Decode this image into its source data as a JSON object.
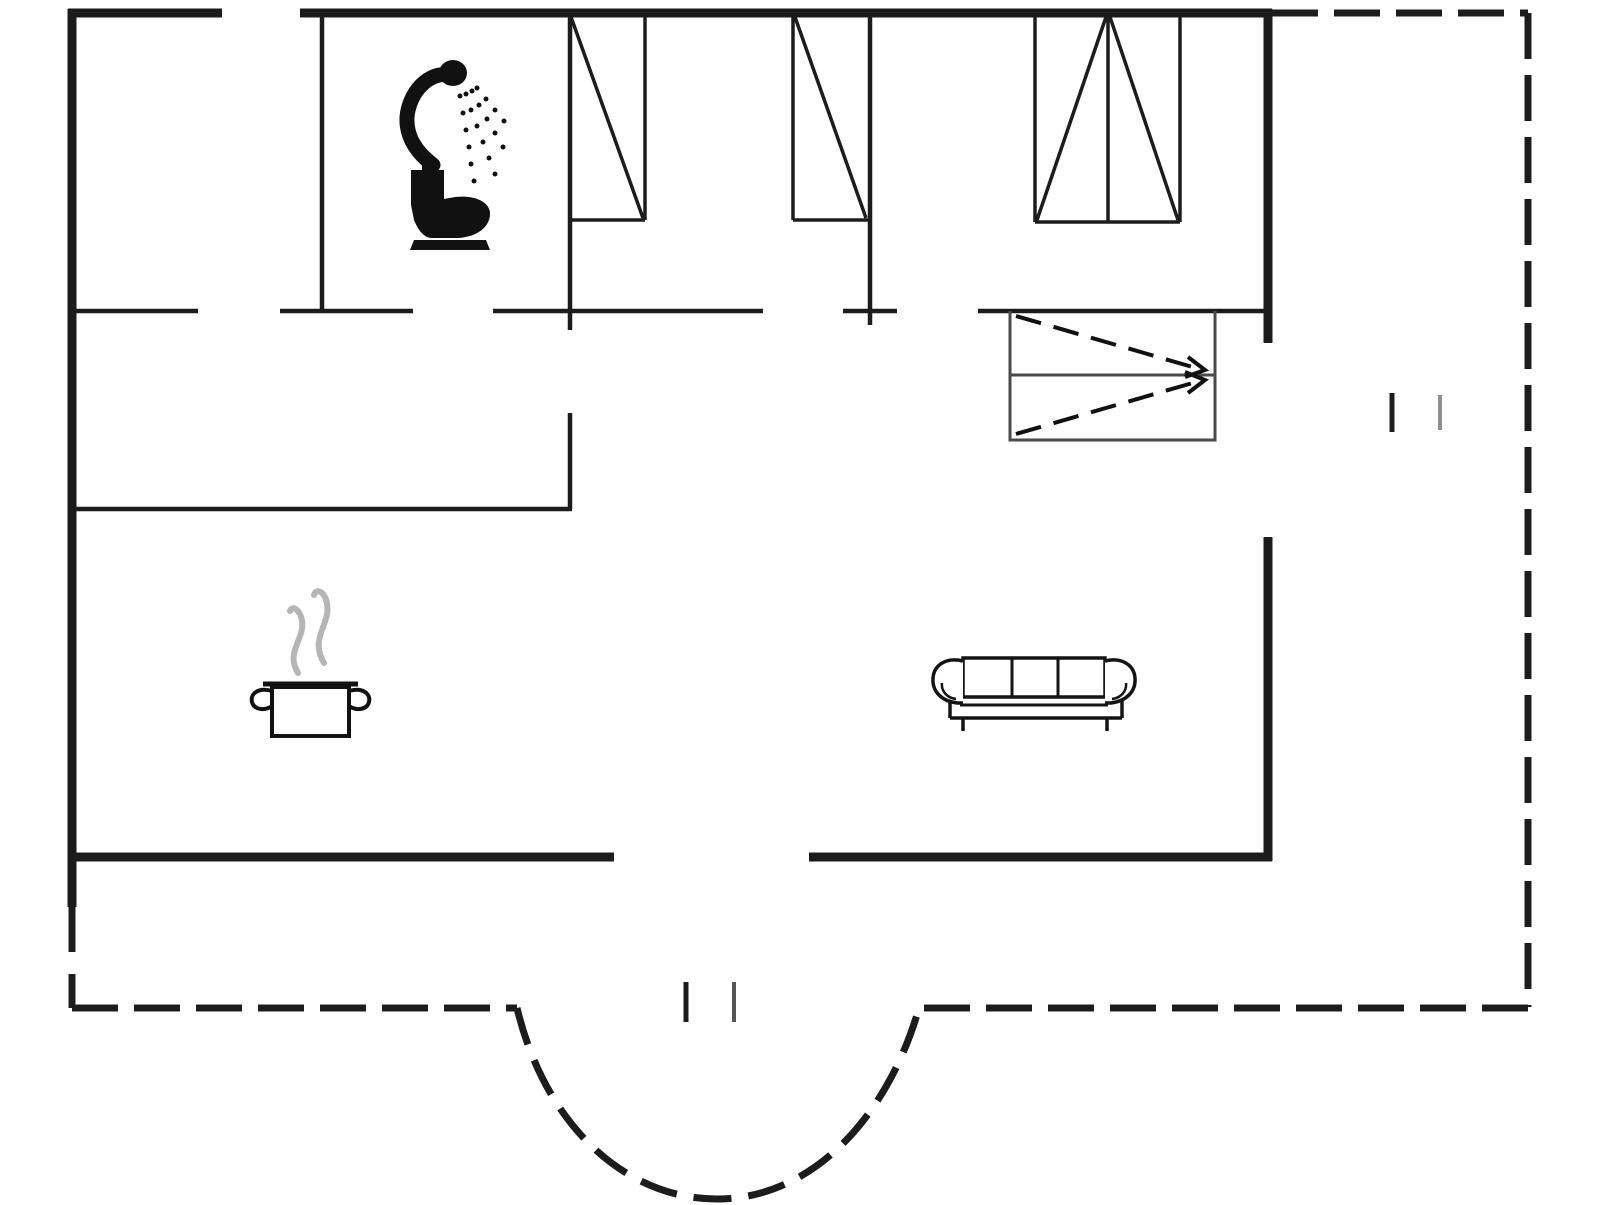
{
  "page": {
    "background": "#ffffff",
    "description": "house floor plan drawing"
  },
  "floorplan": {
    "viewbox": "0 0 1606 1205",
    "colors": {
      "wall": "#1c1c1c",
      "icon": "#111111",
      "closet_outline": "#4a4a4a",
      "steam": "#b5b5b5",
      "tick_dark": "#1c1c1c",
      "tick_light": "#8f8f8f",
      "tick_mid": "#555555",
      "background": "#ffffff"
    },
    "elements": [
      {
        "name": "top-wall-left",
        "kind": "path",
        "d": "M68,13 H222",
        "stroke": "#1c1c1c",
        "width": 9
      },
      {
        "name": "top-wall-main",
        "kind": "path",
        "d": "M300,13 H1272",
        "stroke": "#1c1c1c",
        "width": 9
      },
      {
        "name": "left-wall",
        "kind": "path",
        "d": "M72,9 V907",
        "stroke": "#1c1c1c",
        "width": 9
      },
      {
        "name": "right-wall-upper",
        "kind": "path",
        "d": "M1268,9 V343",
        "stroke": "#1c1c1c",
        "width": 9
      },
      {
        "name": "right-wall-lower",
        "kind": "path",
        "d": "M1268,537 V861",
        "stroke": "#1c1c1c",
        "width": 9
      },
      {
        "name": "bottom-wall-left",
        "kind": "path",
        "d": "M68,857 H614",
        "stroke": "#1c1c1c",
        "width": 9
      },
      {
        "name": "bottom-wall-right",
        "kind": "path",
        "d": "M809,857 H1272",
        "stroke": "#1c1c1c",
        "width": 9
      },
      {
        "name": "terrace-boundary-top",
        "kind": "path",
        "d": "M1272,13 H1528",
        "stroke": "#1c1c1c",
        "width": 7,
        "dash": "46 16"
      },
      {
        "name": "terrace-boundary-right",
        "kind": "path",
        "d": "M1528,13 V1007",
        "stroke": "#1c1c1c",
        "width": 7,
        "dash": "46 16"
      },
      {
        "name": "terrace-boundary-bottom-right",
        "kind": "path",
        "d": "M1528,1008 H919",
        "stroke": "#1c1c1c",
        "width": 7,
        "dash": "46 16"
      },
      {
        "name": "terrace-boundary-bottom-left",
        "kind": "path",
        "d": "M72,1008 H517",
        "stroke": "#1c1c1c",
        "width": 7,
        "dash": "46 16"
      },
      {
        "name": "left-wall-dashed",
        "kind": "path",
        "d": "M72,902 V1008",
        "stroke": "#1c1c1c",
        "width": 7,
        "dash": "50 22"
      },
      {
        "name": "bay-curve",
        "kind": "path",
        "d": "M517,1008 C545,1125 625,1199 717,1199 C809,1199 886,1122 919,1008",
        "stroke": "#1c1c1c",
        "width": 7,
        "dash": "38 17"
      },
      {
        "name": "hall-wall-a",
        "kind": "path",
        "d": "M72,311 H198",
        "stroke": "#1c1c1c",
        "width": 4.5
      },
      {
        "name": "hall-wall-b",
        "kind": "path",
        "d": "M280,311 H413",
        "stroke": "#1c1c1c",
        "width": 4.5
      },
      {
        "name": "hall-wall-c",
        "kind": "path",
        "d": "M493,311 H763",
        "stroke": "#1c1c1c",
        "width": 4.5
      },
      {
        "name": "hall-wall-d",
        "kind": "path",
        "d": "M843,311 H897",
        "stroke": "#1c1c1c",
        "width": 4.5
      },
      {
        "name": "hall-wall-e",
        "kind": "path",
        "d": "M978,311 H1267",
        "stroke": "#1c1c1c",
        "width": 4.5
      },
      {
        "name": "bathroom-wall-left",
        "kind": "path",
        "d": "M322,13 V311",
        "stroke": "#1c1c1c",
        "width": 4.5
      },
      {
        "name": "bathroom-wall-right",
        "kind": "path",
        "d": "M570,13 V330",
        "stroke": "#1c1c1c",
        "width": 4.5
      },
      {
        "name": "kitchen-wall-vertical",
        "kind": "path",
        "d": "M570,413 V509",
        "stroke": "#1c1c1c",
        "width": 4.5
      },
      {
        "name": "kitchen-wall-horizontal",
        "kind": "path",
        "d": "M72,509 H572",
        "stroke": "#1c1c1c",
        "width": 4.5
      },
      {
        "name": "bedroom-divider-wall",
        "kind": "path",
        "d": "M870,13 V325",
        "stroke": "#1c1c1c",
        "width": 4.5
      },
      {
        "name": "wardrobe-1",
        "kind": "path",
        "d": "M645,15 V220 M569,220 H645 M571,17 L643,218",
        "stroke": "#1c1c1c",
        "width": 3.5
      },
      {
        "name": "wardrobe-2",
        "kind": "path",
        "d": "M793,15 V220 M793,220 H868 M795,17 L866,218",
        "stroke": "#1c1c1c",
        "width": 3.5
      },
      {
        "name": "wardrobe-3",
        "kind": "path",
        "d": "M1035,15 V222 M1180,15 V222 M1035,222 H1180 M1108,15 V222 M1037,220 L1106,17 M1110,17 L1178,220",
        "stroke": "#1c1c1c",
        "width": 3.5
      },
      {
        "name": "closet-outline",
        "kind": "path",
        "d": "M1010,311 V440 H1215 V311 M1010,375 H1215",
        "stroke": "#4a4a4a",
        "width": 3
      },
      {
        "name": "closet-arrow-1",
        "kind": "path",
        "d": "M1016,316 L1196,368",
        "stroke": "#111111",
        "width": 4,
        "dash": "26 13"
      },
      {
        "name": "closet-arrow-1-head",
        "kind": "path",
        "d": "M1188,357 L1205,370 L1185,377",
        "stroke": "#111111",
        "width": 4
      },
      {
        "name": "closet-arrow-2",
        "kind": "path",
        "d": "M1016,434 L1196,382",
        "stroke": "#111111",
        "width": 4,
        "dash": "26 13"
      },
      {
        "name": "closet-arrow-2-head",
        "kind": "path",
        "d": "M1188,393 L1205,380 L1185,372",
        "stroke": "#111111",
        "width": 4
      },
      {
        "name": "window-marker-east-tick-1",
        "kind": "path",
        "d": "M1392,393 V432",
        "stroke": "#1c1c1c",
        "width": 5
      },
      {
        "name": "window-marker-east-tick-2",
        "kind": "path",
        "d": "M1440,395 V430",
        "stroke": "#8f8f8f",
        "width": 4
      },
      {
        "name": "door-marker-south-tick-1",
        "kind": "path",
        "d": "M686,982 V1022",
        "stroke": "#1c1c1c",
        "width": 5
      },
      {
        "name": "door-marker-south-tick-2",
        "kind": "path",
        "d": "M734,982 V1022",
        "stroke": "#555555",
        "width": 4
      },
      {
        "name": "shower-icon-head",
        "kind": "path",
        "d": "M439,73 a14,13 0 1,0 28,0 a14,13 0 1,0 -28,0",
        "stroke": "none",
        "width": 0,
        "fill": "#111111"
      },
      {
        "name": "shower-icon-hose",
        "kind": "path",
        "d": "M453,75 C427,70 409,94 407,117 C406,137 416,152 433,165",
        "stroke": "#111111",
        "width": 15,
        "cap": "round"
      },
      {
        "name": "shower-icon-spray-dots",
        "kind": "dots",
        "r": 2.5,
        "fill": "#111111",
        "points": [
          [
            460,
            96
          ],
          [
            463,
            113
          ],
          [
            466,
            130
          ],
          [
            469,
            147
          ],
          [
            471,
            164
          ],
          [
            474,
            181
          ],
          [
            466,
            94
          ],
          [
            471,
            110
          ],
          [
            477,
            126
          ],
          [
            483,
            142
          ],
          [
            489,
            158
          ],
          [
            495,
            174
          ],
          [
            472,
            91
          ],
          [
            479,
            105
          ],
          [
            487,
            119
          ],
          [
            495,
            133
          ],
          [
            503,
            147
          ],
          [
            477,
            88
          ],
          [
            486,
            99
          ],
          [
            495,
            110
          ],
          [
            504,
            121
          ]
        ]
      },
      {
        "name": "toilet-icon",
        "kind": "path",
        "d": "M422,159 H434 V170 H422 Z M411,170 H444 V199 L455,197 C472,195 488,200 490,212 C491,226 478,237 458,238 L432,238 C424,238 418,230 414,220 L411,205 Z M414,240 H486 L490,250 H410 Z",
        "stroke": "none",
        "width": 0,
        "fill": "#111111"
      },
      {
        "name": "steam-wisp-left",
        "kind": "path",
        "d": "M298,673 C285,652 305,639 302,621 C300,609 292,605 290,611",
        "stroke": "#b5b5b5",
        "width": 6,
        "cap": "round"
      },
      {
        "name": "steam-wisp-right",
        "kind": "path",
        "d": "M324,663 C309,638 331,624 327,604 C325,591 316,588 314,595",
        "stroke": "#b5b5b5",
        "width": 6,
        "cap": "round"
      },
      {
        "name": "pot-rim",
        "kind": "path",
        "d": "M263,684 H358",
        "stroke": "#111111",
        "width": 5
      },
      {
        "name": "pot-body",
        "kind": "path",
        "d": "M272,687 H349 V736 H272 Z",
        "stroke": "#111111",
        "width": 4,
        "fill": "#ffffff"
      },
      {
        "name": "pot-handle-left",
        "kind": "path",
        "d": "M272,691 C258,687 250,694 252,702 C254,710 265,711 272,706",
        "stroke": "#111111",
        "width": 4
      },
      {
        "name": "pot-handle-right",
        "kind": "path",
        "d": "M349,691 C363,687 371,694 369,702 C367,710 356,711 349,706",
        "stroke": "#111111",
        "width": 4
      },
      {
        "name": "sofa-back",
        "kind": "path",
        "d": "M963,658 H1105 V697 H963 Z",
        "stroke": "#141414",
        "width": 3.5,
        "fill": "#ffffff"
      },
      {
        "name": "sofa-arm-left",
        "kind": "path",
        "d": "M963,661 C946,657 934,665 933,678 C932,691 941,701 957,703 L963,703",
        "stroke": "#141414",
        "width": 3.5,
        "fill": "#ffffff"
      },
      {
        "name": "sofa-arm-right",
        "kind": "path",
        "d": "M1105,661 C1122,657 1134,665 1135,678 C1136,691 1127,701 1111,703 L1105,703",
        "stroke": "#141414",
        "width": 3.5,
        "fill": "#ffffff"
      },
      {
        "name": "sofa-cushion-dividers",
        "kind": "path",
        "d": "M1012,658 V697 M1058,658 V697",
        "stroke": "#141414",
        "width": 3
      },
      {
        "name": "sofa-seat-line",
        "kind": "path",
        "d": "M960,705 H1108",
        "stroke": "#141414",
        "width": 3
      },
      {
        "name": "sofa-arm-curls",
        "kind": "path",
        "d": "M956,699 C947,698 941,691 942,683 M1112,699 C1121,698 1127,691 1126,683",
        "stroke": "#141414",
        "width": 2.5
      },
      {
        "name": "sofa-base",
        "kind": "path",
        "d": "M950,700 V718 M1122,700 V718 M950,718 H1122 M963,718 V731 M1107,718 V731",
        "stroke": "#141414",
        "width": 3.5
      }
    ]
  }
}
